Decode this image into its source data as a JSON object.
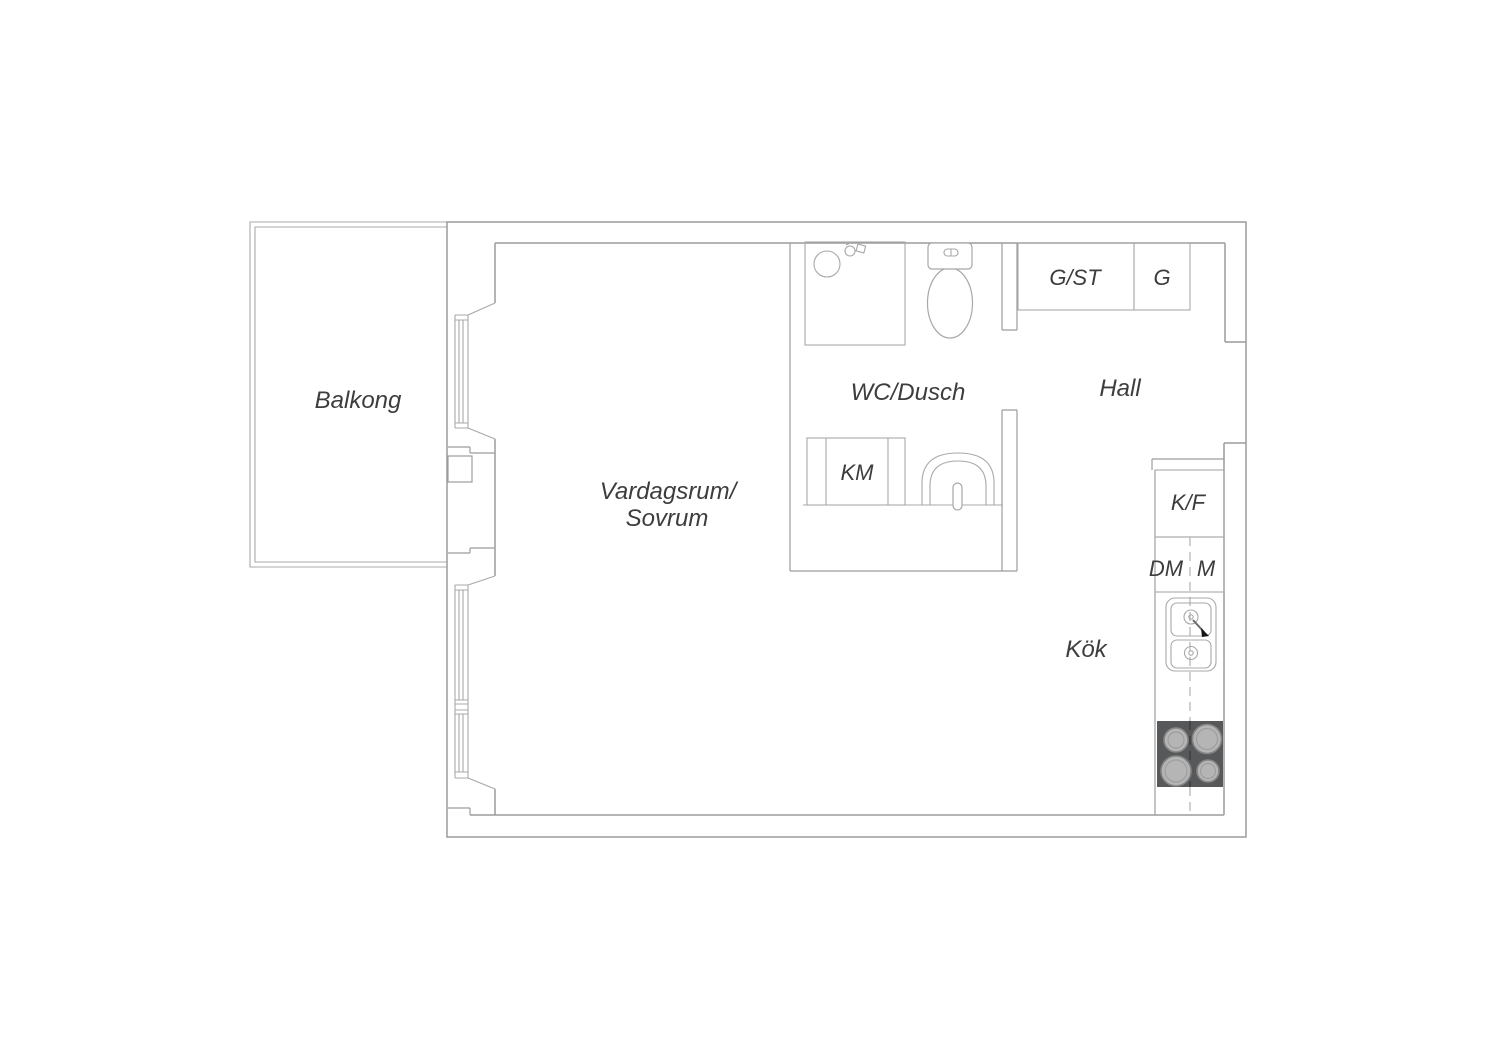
{
  "colors": {
    "background": "#ffffff",
    "wall_line": "#9c9c9c",
    "fixture_line": "#a8a8a8",
    "label_text": "#3d3d3d",
    "stove_body": "#57585a",
    "burner_fill": "#b5b5b5",
    "burner_ring": "#858585",
    "burner_inner": "#9e9e9e",
    "dashed_line": "#bdbdbd",
    "dashed_on_stove": "#3e3e3e",
    "arrow_black": "#141414"
  },
  "rooms": {
    "balcony": {
      "label": "Balkong"
    },
    "living": {
      "label_line1": "Vardagsrum/",
      "label_line2": "Sovrum"
    },
    "bathroom": {
      "label": "WC/Dusch"
    },
    "hall": {
      "label": "Hall"
    },
    "kitchen": {
      "label": "Kök"
    }
  },
  "fixtures": {
    "washing_machine": {
      "label": "KM"
    },
    "closet_large": {
      "label": "G/ST"
    },
    "closet_small": {
      "label": "G"
    },
    "fridge_freezer": {
      "label": "K/F"
    },
    "dishwasher": {
      "label": "DM"
    },
    "microwave": {
      "label": "M"
    }
  },
  "icons": [
    "shower-head-icon",
    "shower-drain-icon",
    "toilet-icon",
    "washbasin-icon",
    "kitchen-sink-icon",
    "faucet-arrow-icon",
    "stove-burners-icon"
  ]
}
